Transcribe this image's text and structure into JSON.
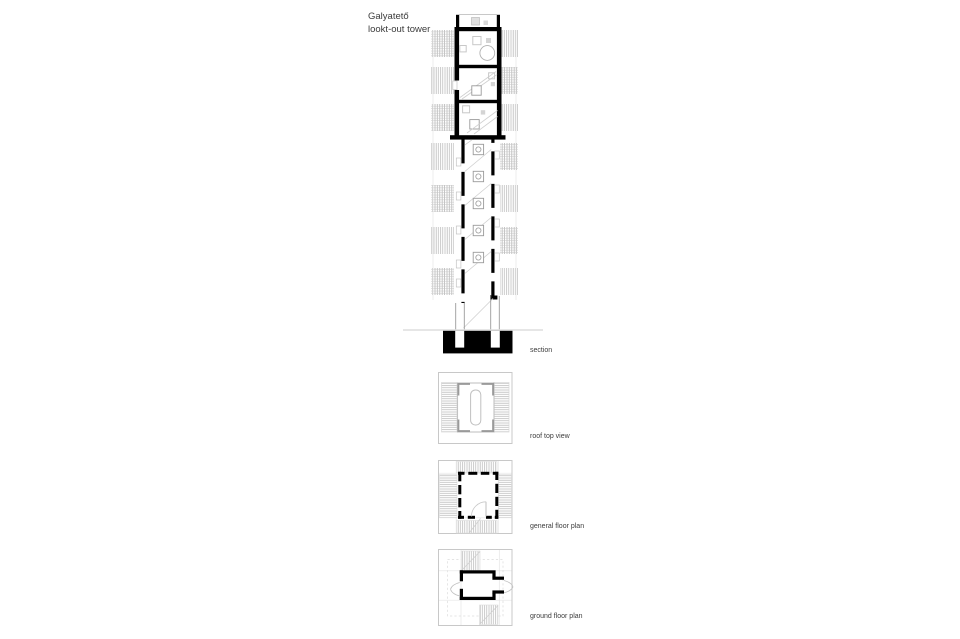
{
  "title": {
    "line1": "Galyatető",
    "line2": "lookt-out tower"
  },
  "drawings": [
    {
      "id": "section",
      "label": "section"
    },
    {
      "id": "roof-top-view",
      "label": "roof top view"
    },
    {
      "id": "general-floor-plan",
      "label": "general floor plan"
    },
    {
      "id": "ground-floor-plan",
      "label": "ground floor plan"
    }
  ],
  "colors": {
    "ink": "#000000",
    "thin_line": "#c8c8c8",
    "hatch": "#b5b5b5",
    "text": "#3c3c3c",
    "background": "#ffffff"
  }
}
